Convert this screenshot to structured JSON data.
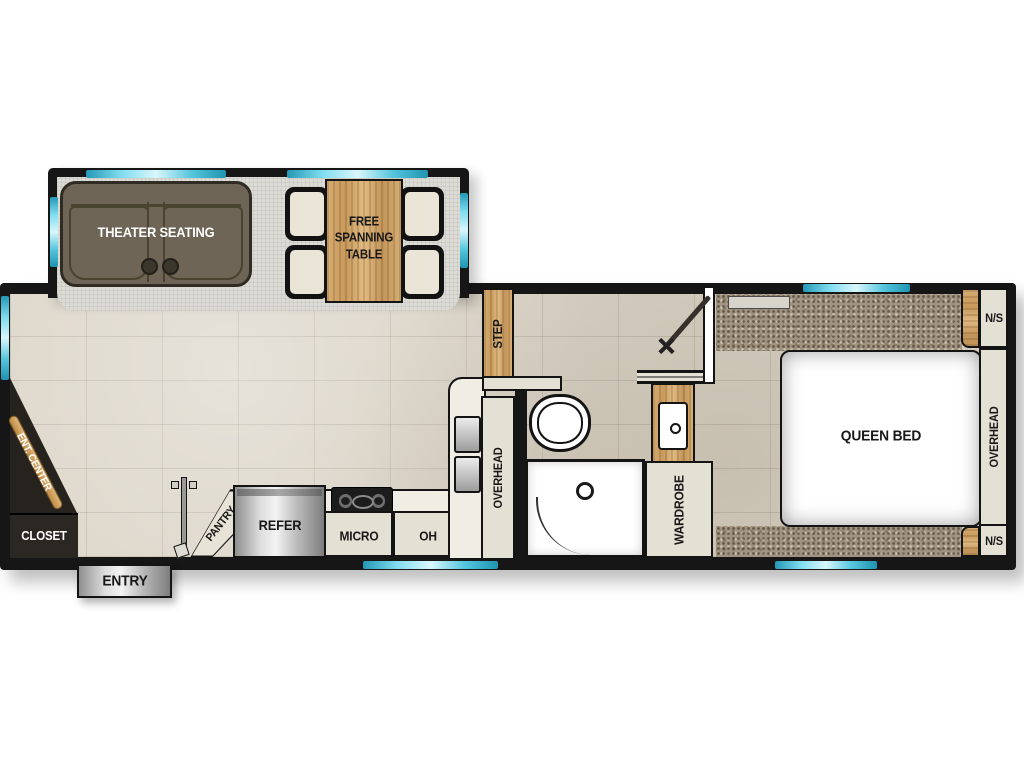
{
  "slideout": {
    "theater_seating": "THEATER SEATING",
    "free_spanning_table": "FREE SPANNING TABLE"
  },
  "entryway": {
    "step": "STEP",
    "entry": "ENTRY"
  },
  "front": {
    "ent_center": "ENT. CENTER",
    "closet": "CLOSET"
  },
  "kitchen": {
    "pantry": "PANTRY",
    "refer": "REFER",
    "micro": "MICRO",
    "oh": "OH",
    "overhead": "OVERHEAD"
  },
  "bathroom": {
    "wardrobe": "WARDROBE"
  },
  "bedroom": {
    "queen_bed": "QUEEN BED",
    "overhead": "OVERHEAD",
    "nightstand_top": "N/S",
    "nightstand_bottom": "N/S"
  },
  "colors": {
    "wall": "#161616",
    "window_accent": "#3db9d6",
    "tile_floor": "#dad3c6",
    "slide_carpet": "#dcdbd6",
    "bedroom_carpet": "#a09480",
    "wood": "#d0a467",
    "cabinet": "#e3e0d4",
    "sofa": "#6e6557",
    "stainless": "#c6c6c6"
  }
}
